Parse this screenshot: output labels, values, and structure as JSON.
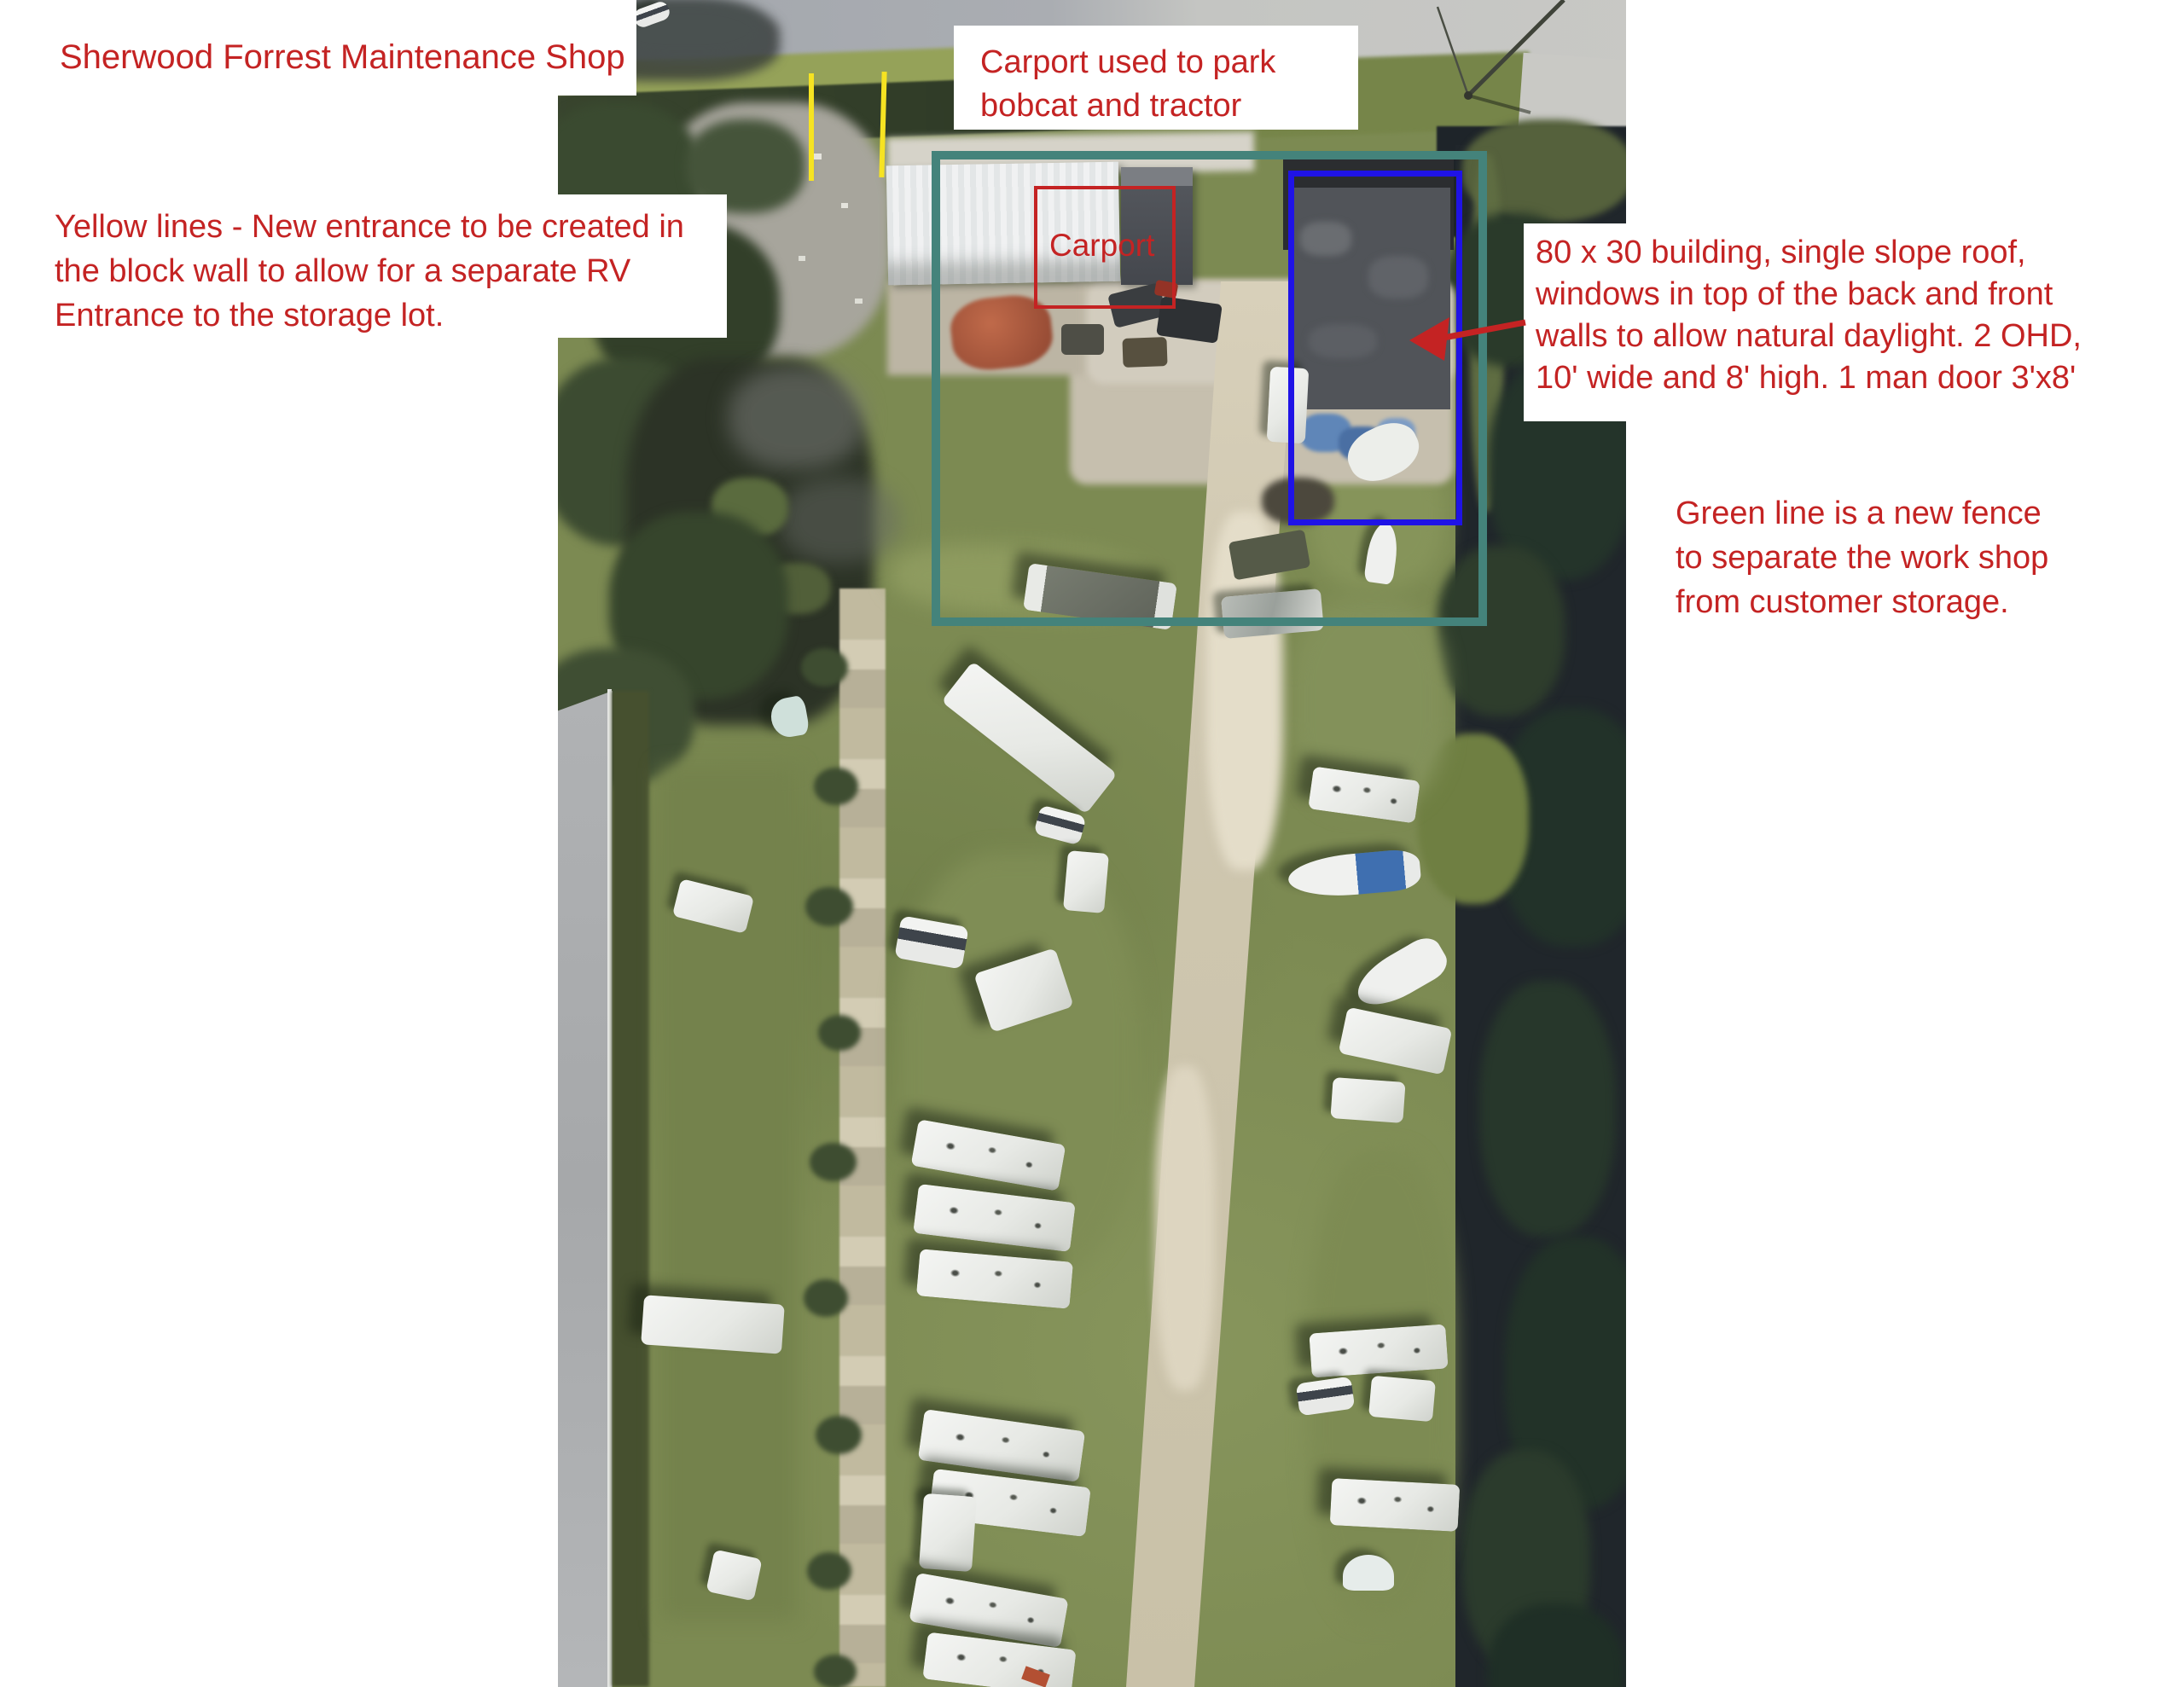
{
  "annotations": {
    "title": "Sherwood Forrest Maintenance Shop",
    "carport_note": [
      "Carport used to park",
      "bobcat and tractor"
    ],
    "entrance_note": [
      "Yellow lines - New entrance to be created in",
      "the block wall to allow for a separate RV",
      "Entrance to the storage lot."
    ],
    "building_note": [
      "80 x 30 building, single slope roof,",
      "windows in top of the back and front",
      "walls to allow natural daylight. 2 OHD,",
      "10' wide and 8' high. 1 man door 3'x8'"
    ],
    "fence_note": [
      "Green line is a new fence",
      "to separate the work shop",
      "from customer storage."
    ],
    "carport_box_label": "Carport"
  },
  "colors": {
    "annotation_red": "#c42323",
    "fence_teal": "#44837b",
    "building_blue": "#1f13e6",
    "entrance_yellow": "#f6e322"
  }
}
